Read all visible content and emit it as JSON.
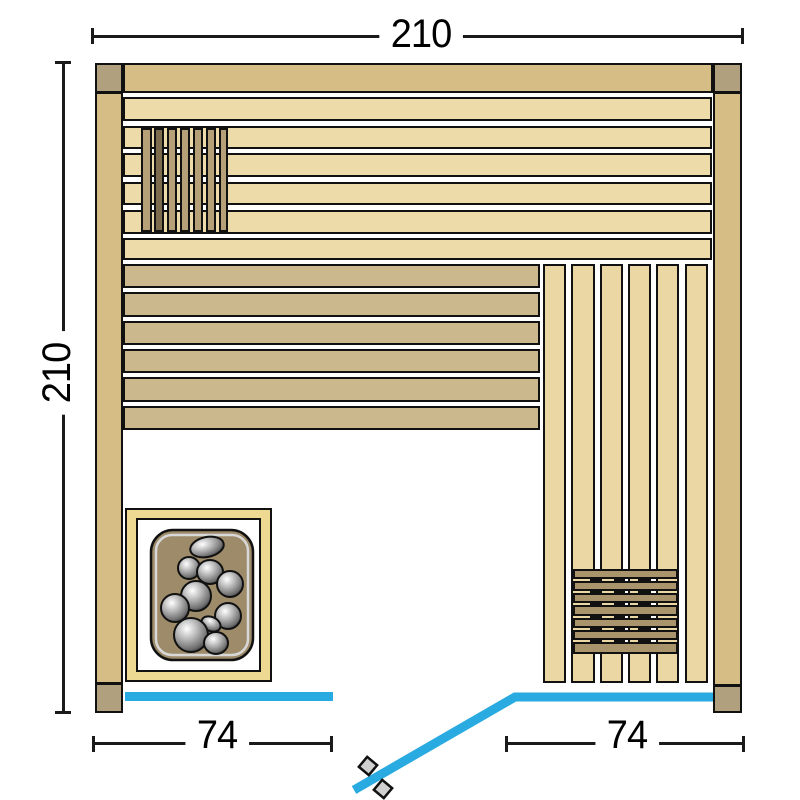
{
  "labels": {
    "top_width": "210",
    "left_height": "210",
    "bottom_left_width": "74",
    "bottom_right_width": "74"
  },
  "colors": {
    "outline": "#111111",
    "wall": "#d5bd85",
    "post": "#b1a07e",
    "upper_bench_plank": "#eedbaa",
    "lower_bench_plank": "#ccb88d",
    "side_bench_plank": "#ebd7a4",
    "backrest_slat": "#b5a078",
    "backrest_slat_dark": "#7d6c4e",
    "duckboard_slat": "#a9946b",
    "heater_frame": "#eed992",
    "heater_inner": "#ffffff",
    "stone_tray": "#9d8b69",
    "tray_inner_line": "#d8d8d8",
    "glass": "#29abe2",
    "handle": "#d0d0d0",
    "dimension_line": "#1a1a1a",
    "floor": "#ffffff"
  },
  "scene": {
    "walls": [
      {
        "name": "wall-top",
        "rect": [
          123,
          63,
          590,
          30
        ]
      },
      {
        "name": "wall-left",
        "rect": [
          95,
          92,
          28,
          592
        ]
      },
      {
        "name": "wall-right",
        "rect": [
          713,
          92,
          29,
          594
        ]
      }
    ],
    "posts": [
      {
        "name": "post-top-left",
        "rect": [
          95,
          63,
          28,
          30
        ]
      },
      {
        "name": "post-top-right",
        "rect": [
          713,
          63,
          29,
          30
        ]
      },
      {
        "name": "post-bottom-left",
        "rect": [
          95,
          683,
          28,
          30
        ]
      },
      {
        "name": "post-bottom-right",
        "rect": [
          713,
          685,
          29,
          28
        ]
      }
    ],
    "upper_bench": {
      "x": 123,
      "w": 589,
      "rows": [
        [
          97,
          24
        ],
        [
          126,
          23
        ],
        [
          153,
          24
        ],
        [
          182,
          23
        ],
        [
          210,
          24
        ],
        [
          238,
          22
        ]
      ]
    },
    "lower_bench": {
      "x": 123,
      "w": 417,
      "rows": [
        [
          264,
          24
        ],
        [
          292,
          25
        ],
        [
          321,
          24
        ],
        [
          349,
          24
        ],
        [
          377,
          25
        ],
        [
          406,
          24
        ]
      ]
    },
    "side_bench": {
      "y": 264,
      "h": 419,
      "cols": [
        [
          543,
          23
        ],
        [
          571,
          24
        ],
        [
          600,
          23
        ],
        [
          628,
          23
        ],
        [
          656,
          23
        ],
        [
          685,
          23
        ]
      ]
    },
    "backrest": {
      "y": 128,
      "h": 104,
      "dark_slats": [
        1
      ],
      "slats": [
        [
          141,
          11
        ],
        [
          154,
          10
        ],
        [
          167,
          10
        ],
        [
          180,
          10
        ],
        [
          193,
          10
        ],
        [
          206,
          10
        ],
        [
          219,
          9
        ]
      ]
    },
    "duckboard": {
      "x": 573,
      "w": 105,
      "dash_cols": [
        590,
        614,
        638
      ],
      "dash_w": 11,
      "slats": [
        [
          569,
          10
        ],
        [
          581,
          10
        ],
        [
          593,
          10
        ],
        [
          605,
          11
        ],
        [
          618,
          10
        ],
        [
          630,
          10
        ],
        [
          642,
          12
        ]
      ]
    },
    "heater": {
      "frame": [
        125,
        508,
        147,
        174
      ],
      "inner": [
        136,
        518,
        125,
        154
      ],
      "tray": [
        151,
        530,
        102,
        130
      ],
      "tray_radius": 22,
      "stones": [
        [
          207,
          547,
          17,
          10,
          -12
        ],
        [
          189,
          568,
          11,
          11,
          0
        ],
        [
          210,
          572,
          13,
          12,
          0
        ],
        [
          230,
          584,
          13,
          13,
          0
        ],
        [
          196,
          596,
          15,
          15,
          0
        ],
        [
          175,
          608,
          14,
          14,
          0
        ],
        [
          228,
          616,
          13,
          13,
          0
        ],
        [
          211,
          624,
          10,
          7,
          25
        ],
        [
          191,
          635,
          17,
          17,
          0
        ],
        [
          216,
          643,
          12,
          11,
          0
        ]
      ]
    },
    "glass": {
      "left_panel": [
        125,
        692,
        208,
        9
      ],
      "door_path": [
        [
          713,
          697
        ],
        [
          515,
          697
        ],
        [
          354,
          790
        ]
      ],
      "stroke_width": 9,
      "handles": [
        {
          "cx": 368,
          "cy": 766,
          "size": 13,
          "rot": 40
        },
        {
          "cx": 383,
          "cy": 789,
          "size": 13,
          "rot": 40
        }
      ]
    }
  }
}
